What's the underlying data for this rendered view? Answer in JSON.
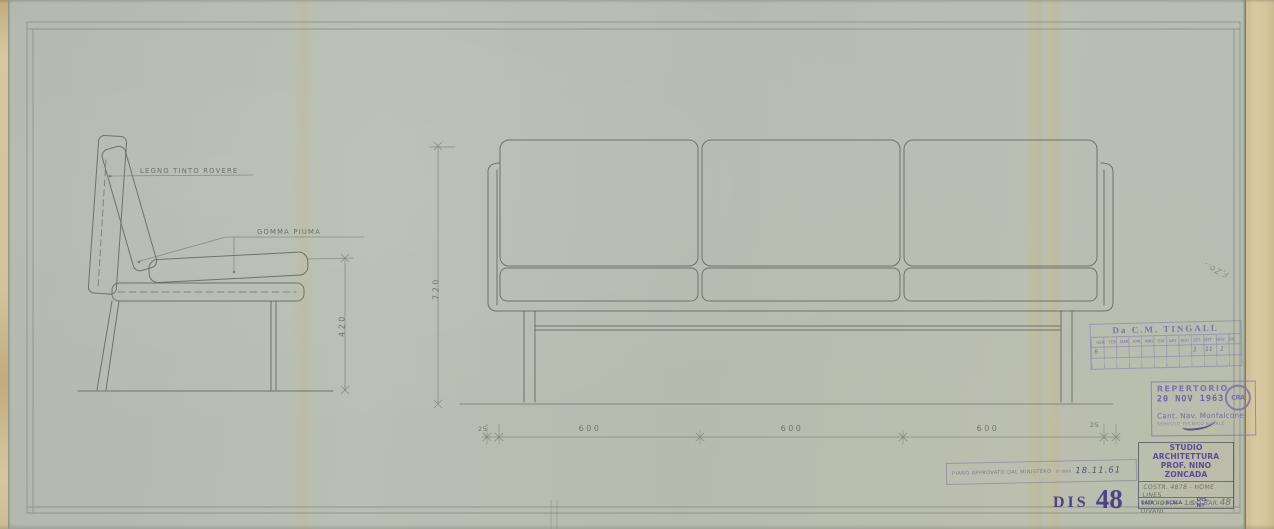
{
  "drawing": {
    "labels": {
      "legno": "LEGNO TINTO ROVERE",
      "gomma": "GOMMA PIUMA"
    },
    "dimensions": {
      "total_height": "720",
      "seat_height": "420",
      "module_1": "600",
      "module_2": "600",
      "module_3": "600",
      "end_left": "25",
      "end_right": "25"
    }
  },
  "stamps": {
    "tingall": {
      "title": "Da C.M. TINGALL",
      "months": "GEN FEB MAR APR MAG GIU LUG AGO SET OTT NOV DIC",
      "marks": {
        "m1": "6",
        "m2": "1",
        "m3": "11",
        "m4": "1"
      }
    },
    "repertorio": {
      "line1": "REPERTORIO",
      "date": "20 NOV 1963",
      "logo": "CRA",
      "line2": "Cant. Nav. Monfalcone",
      "line3": "SERVIZIO TECNICO NAVALE"
    },
    "ministero": {
      "text": "PIANO APPROVATO DAL MINISTERO",
      "in_data": "in data",
      "date": "18.11.61"
    },
    "dis": {
      "prefix": "DIS",
      "number": "48"
    }
  },
  "title_block": {
    "studio_line1": "STUDIO ARCHITETTURA",
    "studio_line2": "PROF. NINO ZONCADA",
    "note_line1": "COSTR. 4878 - HOME LINES",
    "note_line2": "LIDO DECK - LIDO BAR.",
    "note_line3": "DIVANI",
    "data_label": "DATA",
    "data_value": "49",
    "scala_label": "SCALA",
    "scala_value": "1:5",
    "dis_label": "DIS. Nº",
    "dis_value": "48"
  },
  "notes": {
    "margin_note": "F.Zo.."
  }
}
